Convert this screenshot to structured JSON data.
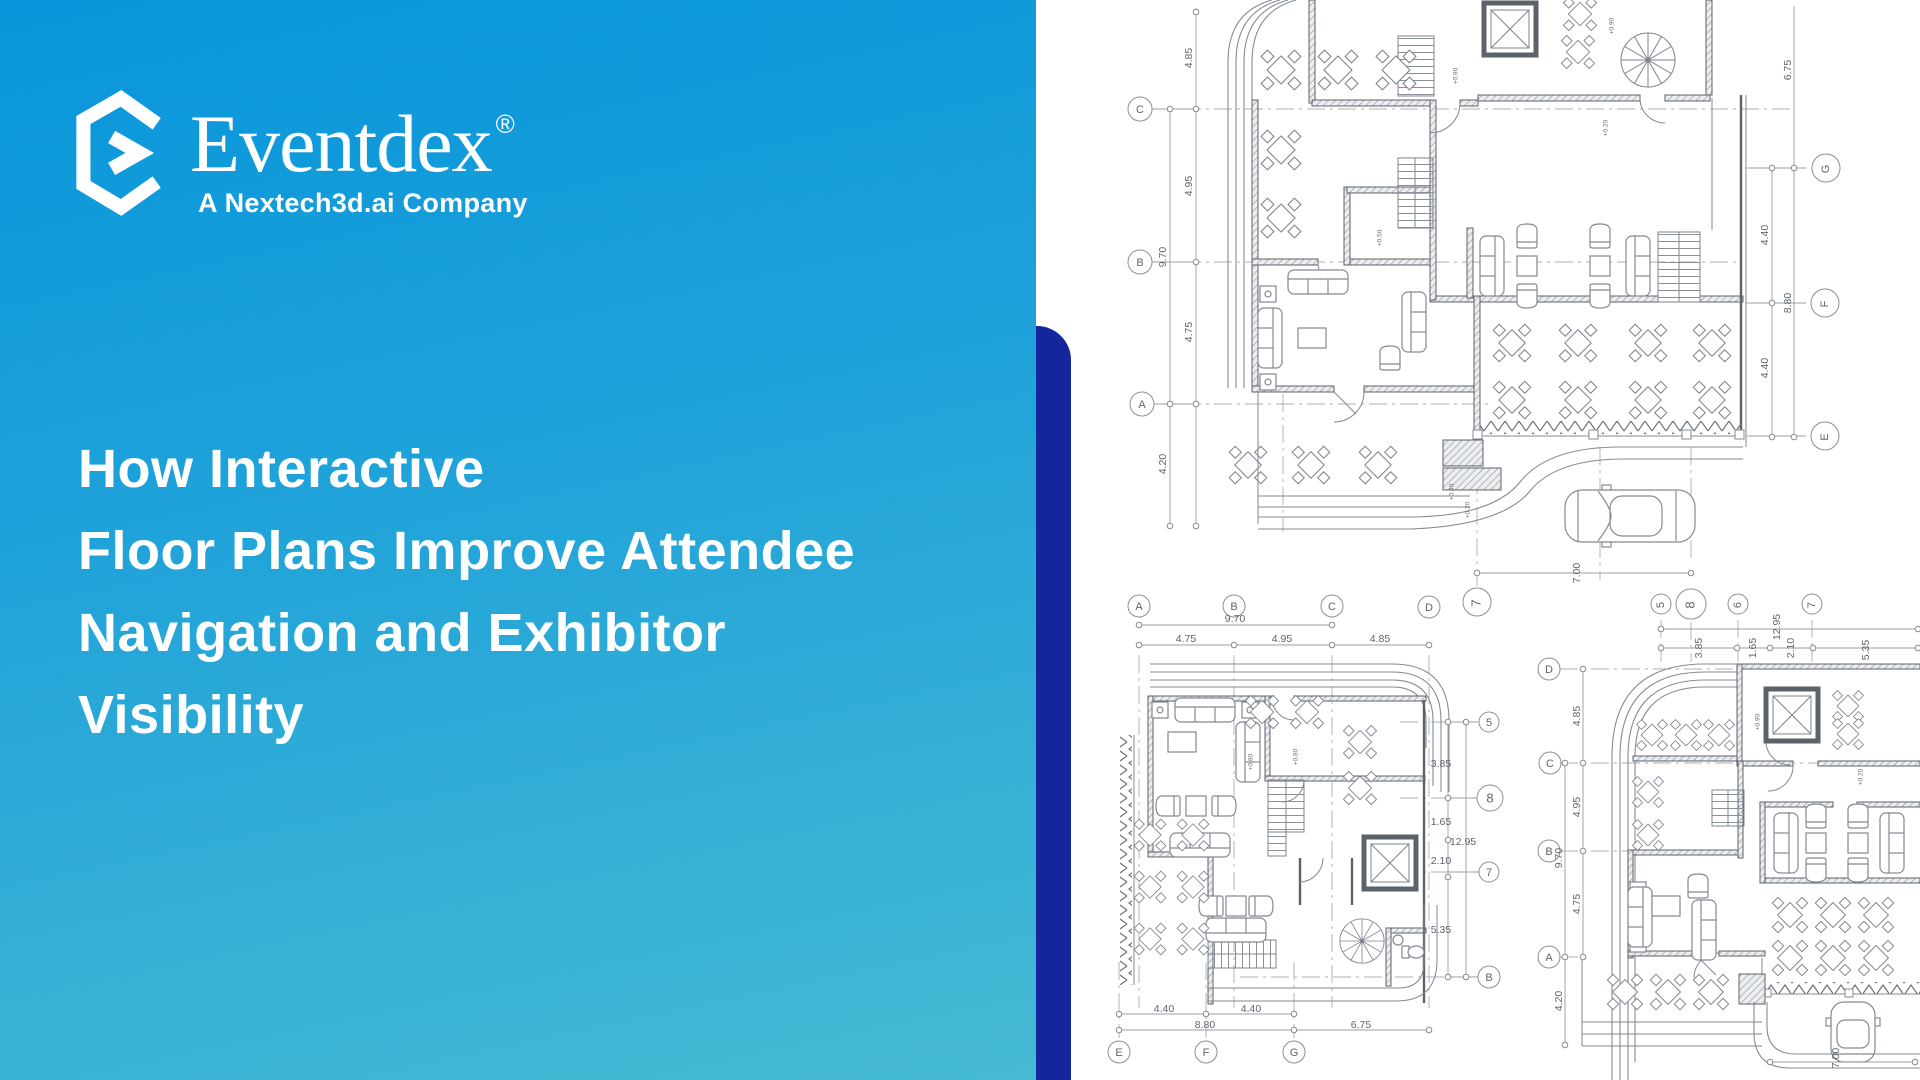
{
  "brand": {
    "name": "Eventdex",
    "registered": "®",
    "tagline": "A Nextech3d.ai Company"
  },
  "headline": {
    "line1": "How Interactive",
    "line2": "Floor Plans Improve Attendee",
    "line3": "Navigation and Exhibitor",
    "line4": "Visibility"
  },
  "colors": {
    "panel_gradient_start": "#0795DB",
    "panel_gradient_end": "#46BAD3",
    "accent_navy": "#15259C",
    "plan_line_gray": "#818790",
    "text_white": "#FFFFFF"
  },
  "p1": {
    "lb": [
      "C",
      "B",
      "A"
    ],
    "ld": [
      "4.85",
      "4.95",
      "4.75",
      "9.70",
      "4.20"
    ],
    "rb": [
      "G",
      "F",
      "E"
    ],
    "rd": [
      "6.75",
      "4.40",
      "8.80",
      "4.40"
    ],
    "bd": "7.00",
    "el": [
      "+0.90",
      "+0.90",
      "+0.20",
      "+0.50",
      "+0.40",
      "+0.20"
    ]
  },
  "p2": {
    "tb": [
      "A",
      "B",
      "C",
      "D"
    ],
    "b7": "7",
    "td": [
      "9.70",
      "4.75",
      "4.95",
      "4.85"
    ],
    "rd": [
      "3.85",
      "1.65",
      "2.10",
      "5.35",
      "12.95"
    ],
    "rb": [
      "5",
      "8",
      "7",
      "B"
    ],
    "bd": [
      "4.40",
      "4.40",
      "8.80",
      "6.75"
    ],
    "bb": [
      "E",
      "F",
      "G"
    ],
    "el": [
      "+0.80",
      "+0.80"
    ]
  },
  "p3": {
    "tb": [
      "5",
      "8",
      "6",
      "7"
    ],
    "td": [
      "12.95",
      "3.85",
      "1.65",
      "2.10",
      "5.35"
    ],
    "lb": [
      "D",
      "C",
      "B",
      "A"
    ],
    "ld": [
      "4.85",
      "4.95",
      "4.75",
      "9.70",
      "4.20"
    ],
    "bd": "7.00",
    "el": [
      "+0.90",
      "+0.20"
    ]
  }
}
